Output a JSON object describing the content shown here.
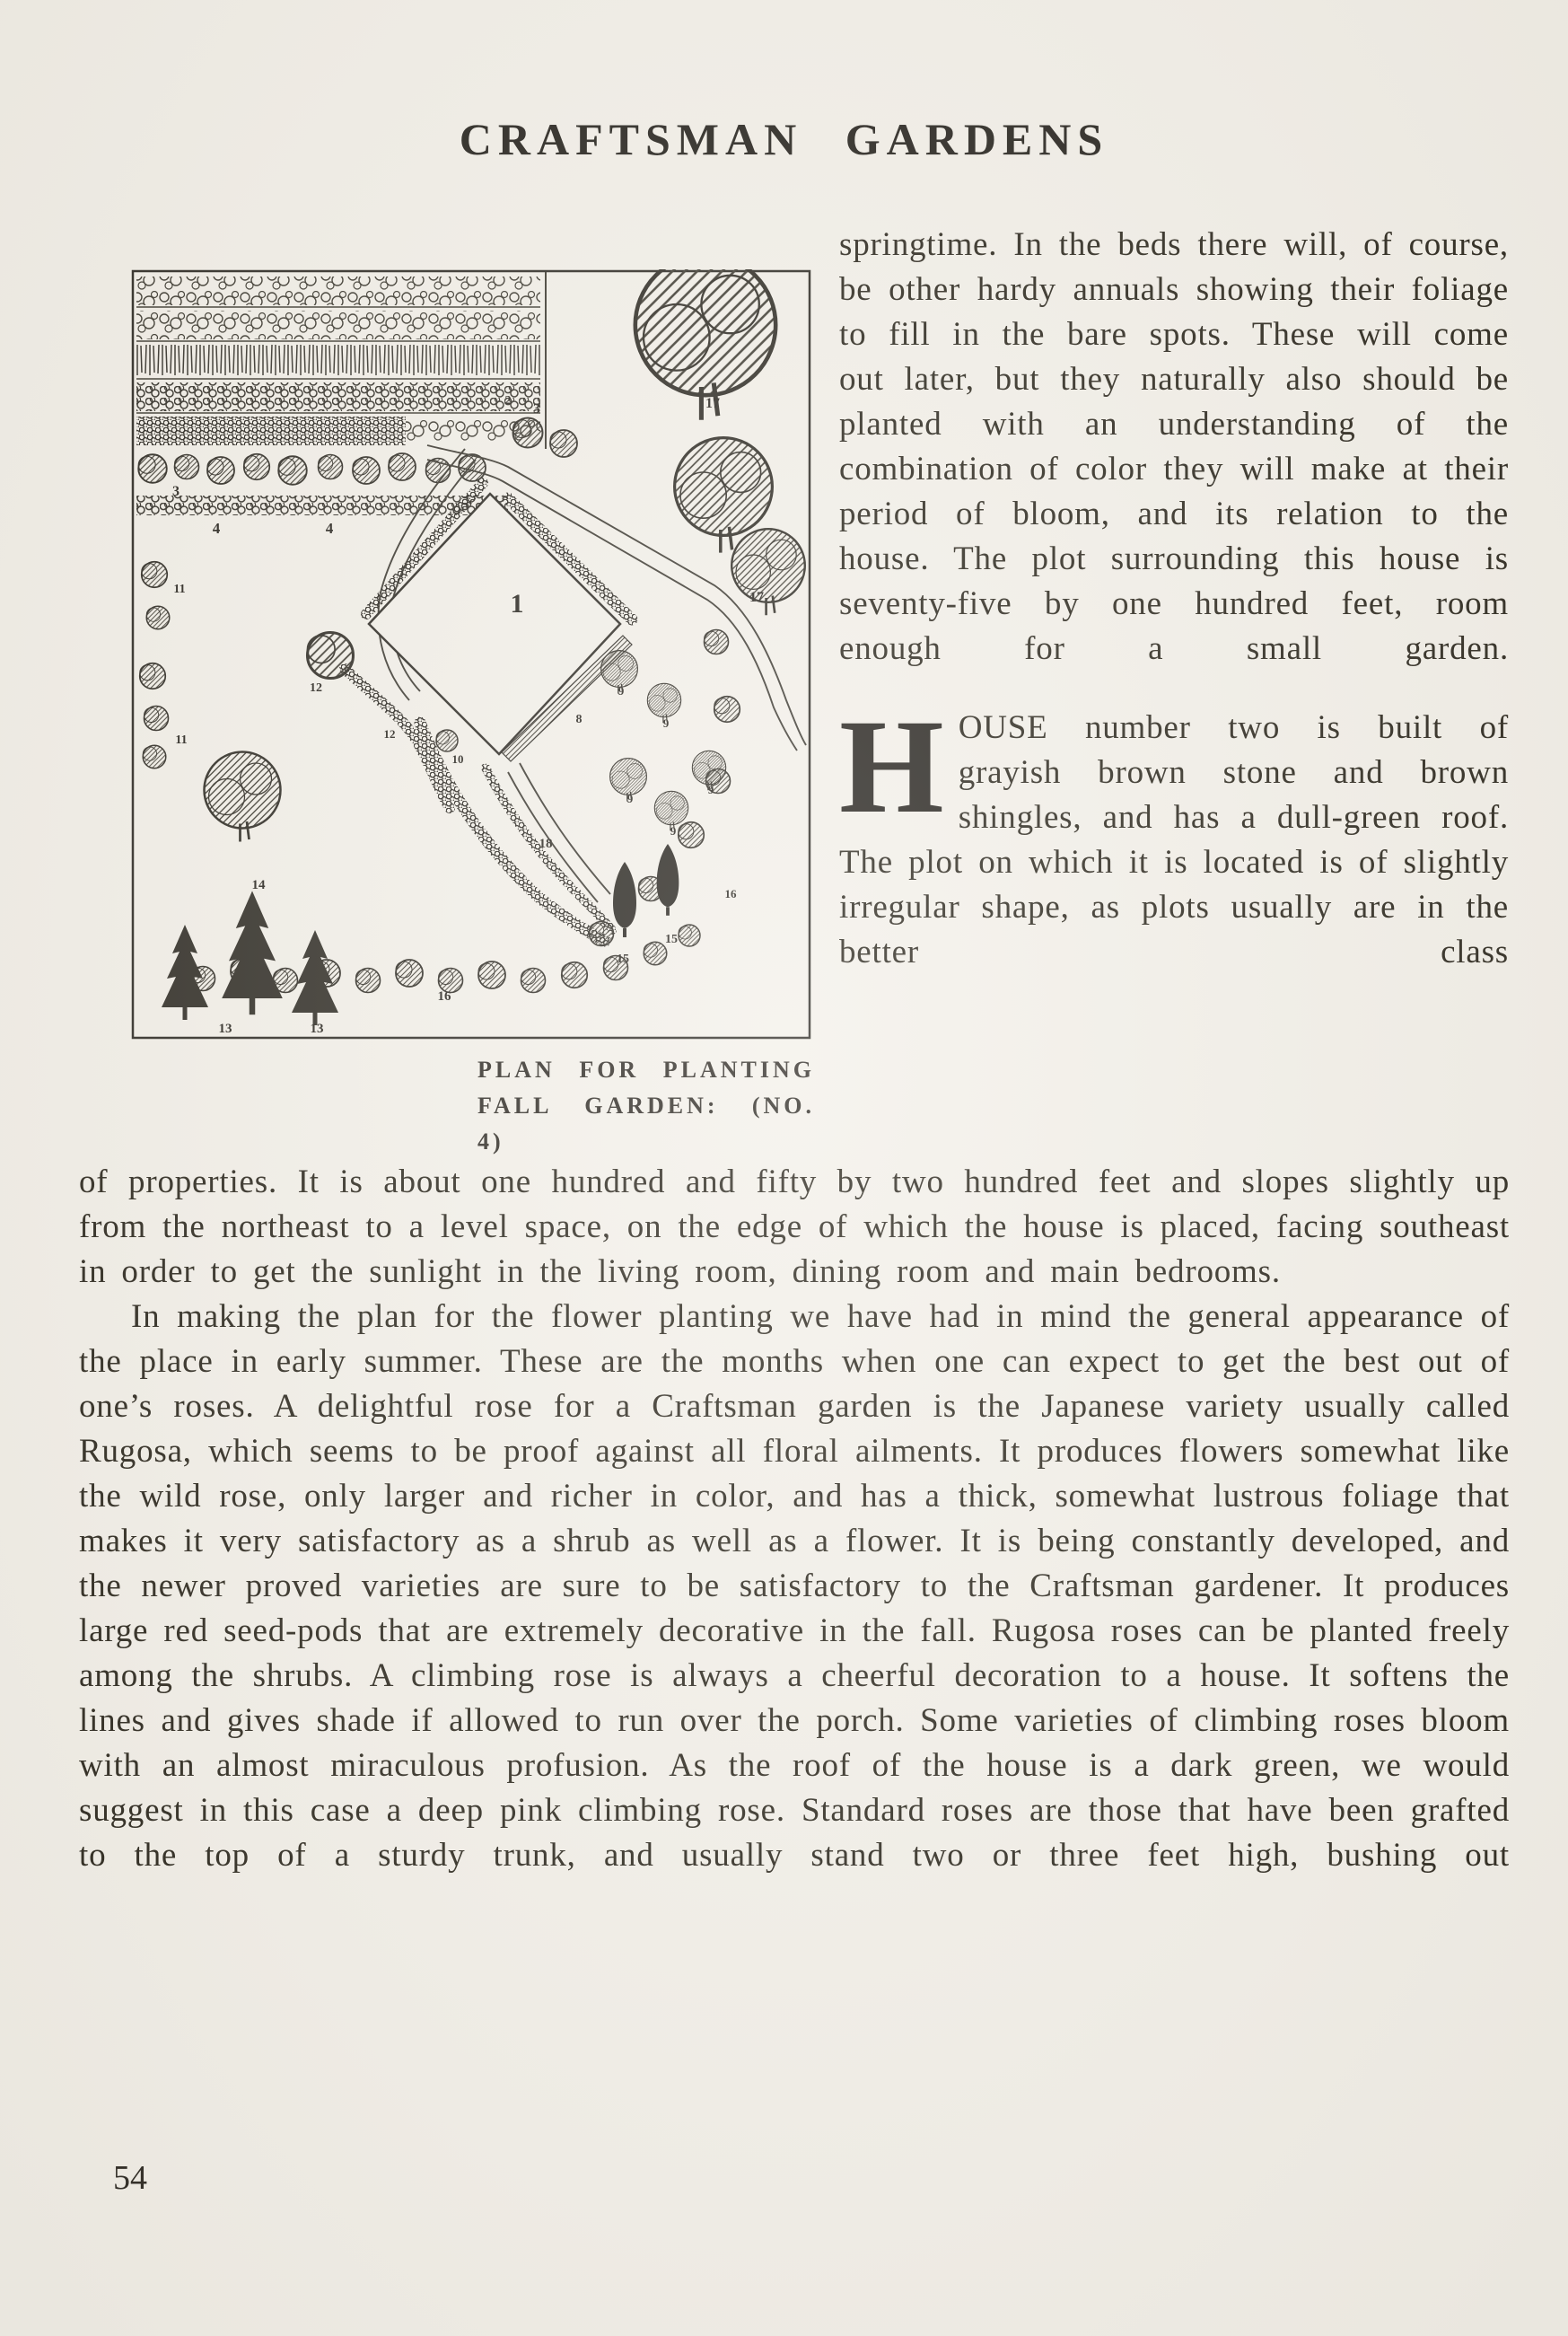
{
  "colors": {
    "paper": "#f3f0e9",
    "ink": "#272319"
  },
  "page": {
    "title": "CRAFTSMAN GARDENS",
    "page_number": "54"
  },
  "figure": {
    "caption_line1": "PLAN FOR PLANTING",
    "caption_line2": "FALL GARDEN: (NO. 4)",
    "plan_labels": {
      "house": "1",
      "bed2": "2",
      "row3a": "3",
      "row3b": "3",
      "hedge4a": "4",
      "hedge4b": "4",
      "n8": "8",
      "n9a": "9",
      "n9b": "9",
      "n9c": "9",
      "n9d": "9",
      "n9e": "9",
      "n10": "10",
      "n11a": "11",
      "n11b": "11",
      "n12a": "12",
      "n12b": "12",
      "n13a": "13",
      "n13b": "13",
      "n14": "14",
      "n15a": "15",
      "n15b": "15",
      "n16a": "16",
      "n16b": "16",
      "n17a": "17",
      "n17b": "17",
      "n18": "18"
    }
  },
  "right_column": {
    "para1": "springtime.  In the beds there will, of course, be other hardy annuals showing their foliage to fill in the bare spots.  These will come out later, but they naturally also should be planted with an understanding of the combination of color they will make at their period of bloom, and its relation to the house. The plot surrounding this house is seventy-five by one hundred feet, room enough for a small garden.",
    "para2_dropcap": "H",
    "para2_rest": "OUSE number two is built of grayish brown stone and brown shingles, and has a dull-green roof.  The plot on which it is located is of slightly irregular shape, as plots usually are in the better class"
  },
  "main_text": {
    "para1_cont": "of properties.  It is about one hundred and fifty by two hundred feet and slopes slightly up from the northeast to a level space, on the edge of which the house is placed, facing southeast in order to get the sunlight in the living room, dining room and main bedrooms.",
    "para2": "In making the plan for the flower planting we have had in mind the general appearance of the place in early summer.  These are the months when one can expect to get the best out of one’s roses. A delightful rose for a Craftsman garden is the Japanese variety usually called Rugosa, which seems to be proof against all floral ailments.  It produces flowers somewhat like the wild rose, only larger and richer in color, and has a thick, somewhat lustrous foliage that makes it very satisfactory as a shrub as well as a flower.  It is being constantly developed, and the newer proved varieties are sure to be satisfactory to the Craftsman gardener.  It produces large red seed-pods that are extremely decorative in the fall.  Rugosa roses can be planted freely among the shrubs.  A climbing rose is always a cheerful decoration to a house.  It softens the lines and gives shade if allowed to run over the porch.  Some varieties of climbing roses bloom with an almost miraculous profusion.  As the roof of the house is a dark green, we would suggest in this case a deep pink climbing rose.  Standard roses are those that have been grafted to the top of a sturdy trunk, and usually stand two or three feet high, bushing out"
  }
}
